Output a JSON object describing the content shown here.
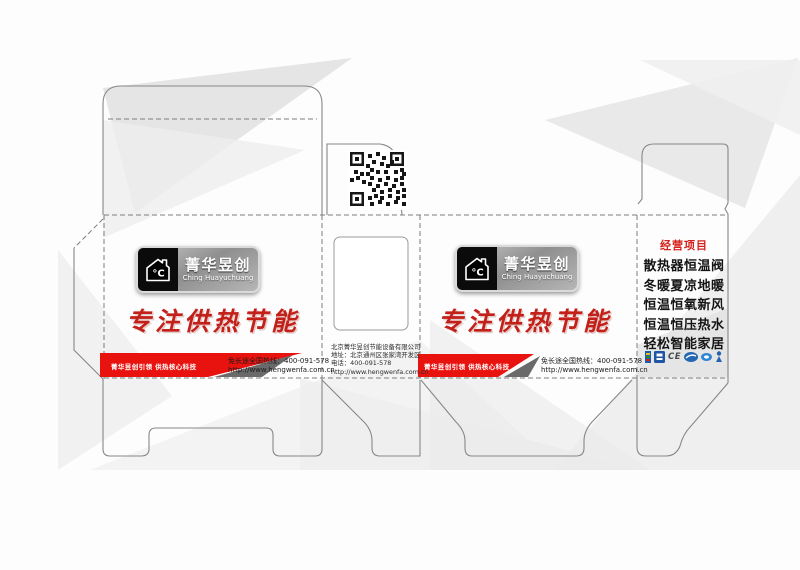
{
  "colors": {
    "banner_red": "#e8120e",
    "slogan_red": "#c3201a",
    "triangle_gray": "#6a6a6a",
    "biz_title_red": "#d3201a"
  },
  "brand": {
    "name_cn": "菁华昱创",
    "name_en": "Ching Huayuchuang",
    "degree_mark": "°C"
  },
  "slogan": {
    "text": "专注供热节能"
  },
  "banner": {
    "tagline": "菁华昱创引领 供热核心科技"
  },
  "contact": {
    "hotline": "免长途全国热线：400-091-578",
    "website": "http://www.hengwenfa.com.cn"
  },
  "company": {
    "name": "北京菁华昱创节能设备有限公司",
    "address": "地址：北京通州区张家湾开发区",
    "phone": "电话：400-091-578",
    "website": "http://www.hengwenfa.com.cn"
  },
  "business": {
    "title": "经营项目",
    "items": [
      "散热器恒温阀",
      "冬暖夏凉地暖",
      "恒温恒氧新风",
      "恒温恒压热水",
      "轻松智能家居"
    ]
  },
  "certs": {
    "ce_label": "CE"
  }
}
